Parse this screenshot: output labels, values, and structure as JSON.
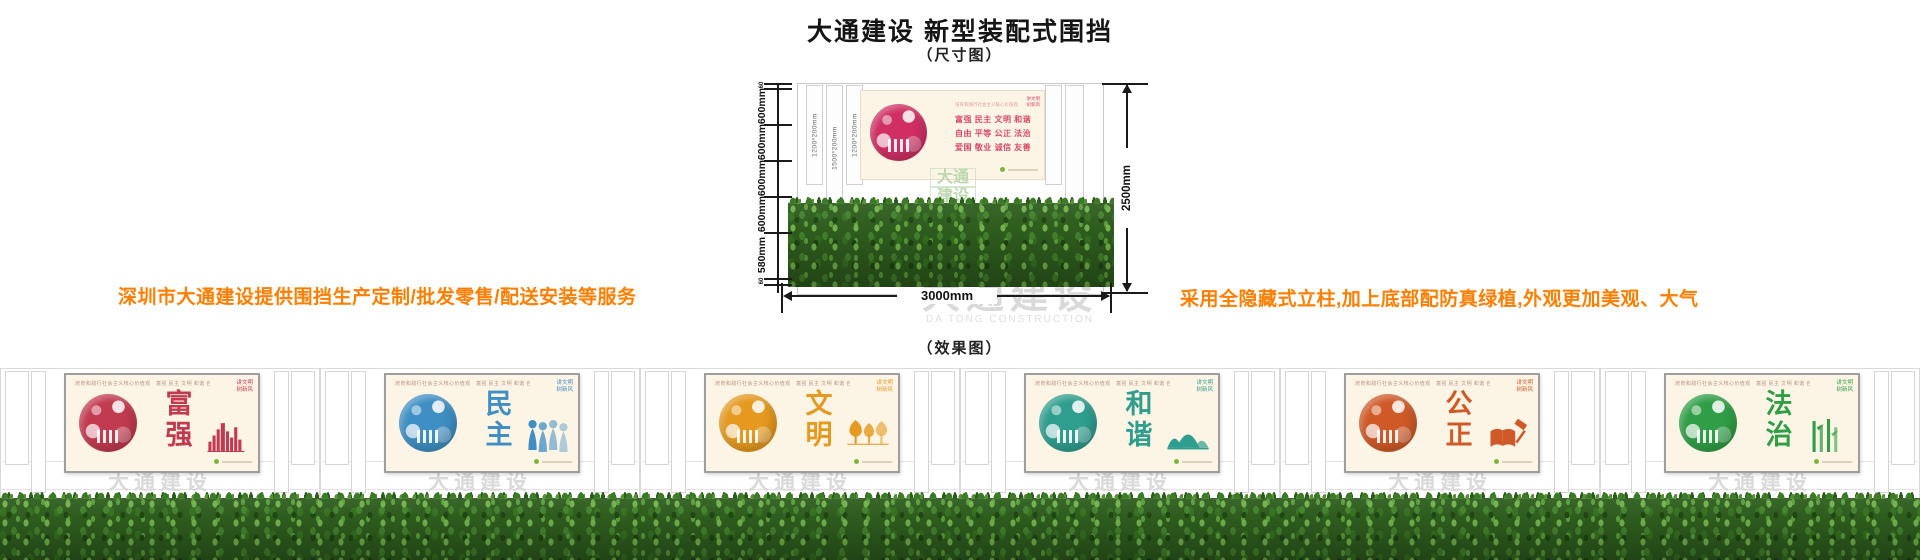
{
  "title": "大通建设 新型装配式围挡",
  "captions": {
    "dimension": "（尺寸图）",
    "effect": "（效果图）"
  },
  "notes": {
    "left": "深圳市大通建设提供围挡生产定制/批发零售/配送安装等服务",
    "right": "采用全隐藏式立柱,加上底部配防真绿植,外观更加美观、大气"
  },
  "colors": {
    "note_orange": "#ff7e00",
    "panel_cream": "#fcf4e4",
    "watermark_gray": "#d9d9d9",
    "hedge_green": "#2e5d1e",
    "footer_dot_green": "#7cb83f"
  },
  "watermark": {
    "cn": "大通建设",
    "en": "DA TONG CONSTRUCTION"
  },
  "dimension_diagram": {
    "left_ruler_labels": [
      "60",
      "600mm",
      "600mm",
      "600mm",
      "600mm",
      "580mm",
      "60"
    ],
    "height_label": "2500mm",
    "width_label": "3000mm",
    "column_labels": [
      "1200*200mm",
      "1500*200mm",
      "1200*200mm"
    ],
    "panel": {
      "header": "培育和践行社会主义核心价值观",
      "rows": [
        "富强  民主  文明  和谐",
        "自由  平等  公正  法治",
        "爱国  敬业  诚信  友善"
      ],
      "corner_lines": [
        "讲文明",
        "树新风"
      ],
      "accent": "#cf2f63"
    }
  },
  "effect_row": {
    "panel_header": "培育和践行社会主义核心价值观　富强 民主 文明 和谐 自由 平等 公正 法治 爱国 敬业 诚信 友善",
    "corner_lines": [
      "讲文明",
      "树新风"
    ],
    "panels": [
      {
        "word": "富强",
        "accent": "#c23a50",
        "motif": "city-skyline"
      },
      {
        "word": "民主",
        "accent": "#3f8fc4",
        "motif": "people-figures"
      },
      {
        "word": "文明",
        "accent": "#e5991f",
        "motif": "trees"
      },
      {
        "word": "和谐",
        "accent": "#2f9e8f",
        "motif": "mountains"
      },
      {
        "word": "公正",
        "accent": "#cf5a28",
        "motif": "book-gavel"
      },
      {
        "word": "法治",
        "accent": "#2f9e46",
        "motif": "bamboo"
      }
    ]
  }
}
